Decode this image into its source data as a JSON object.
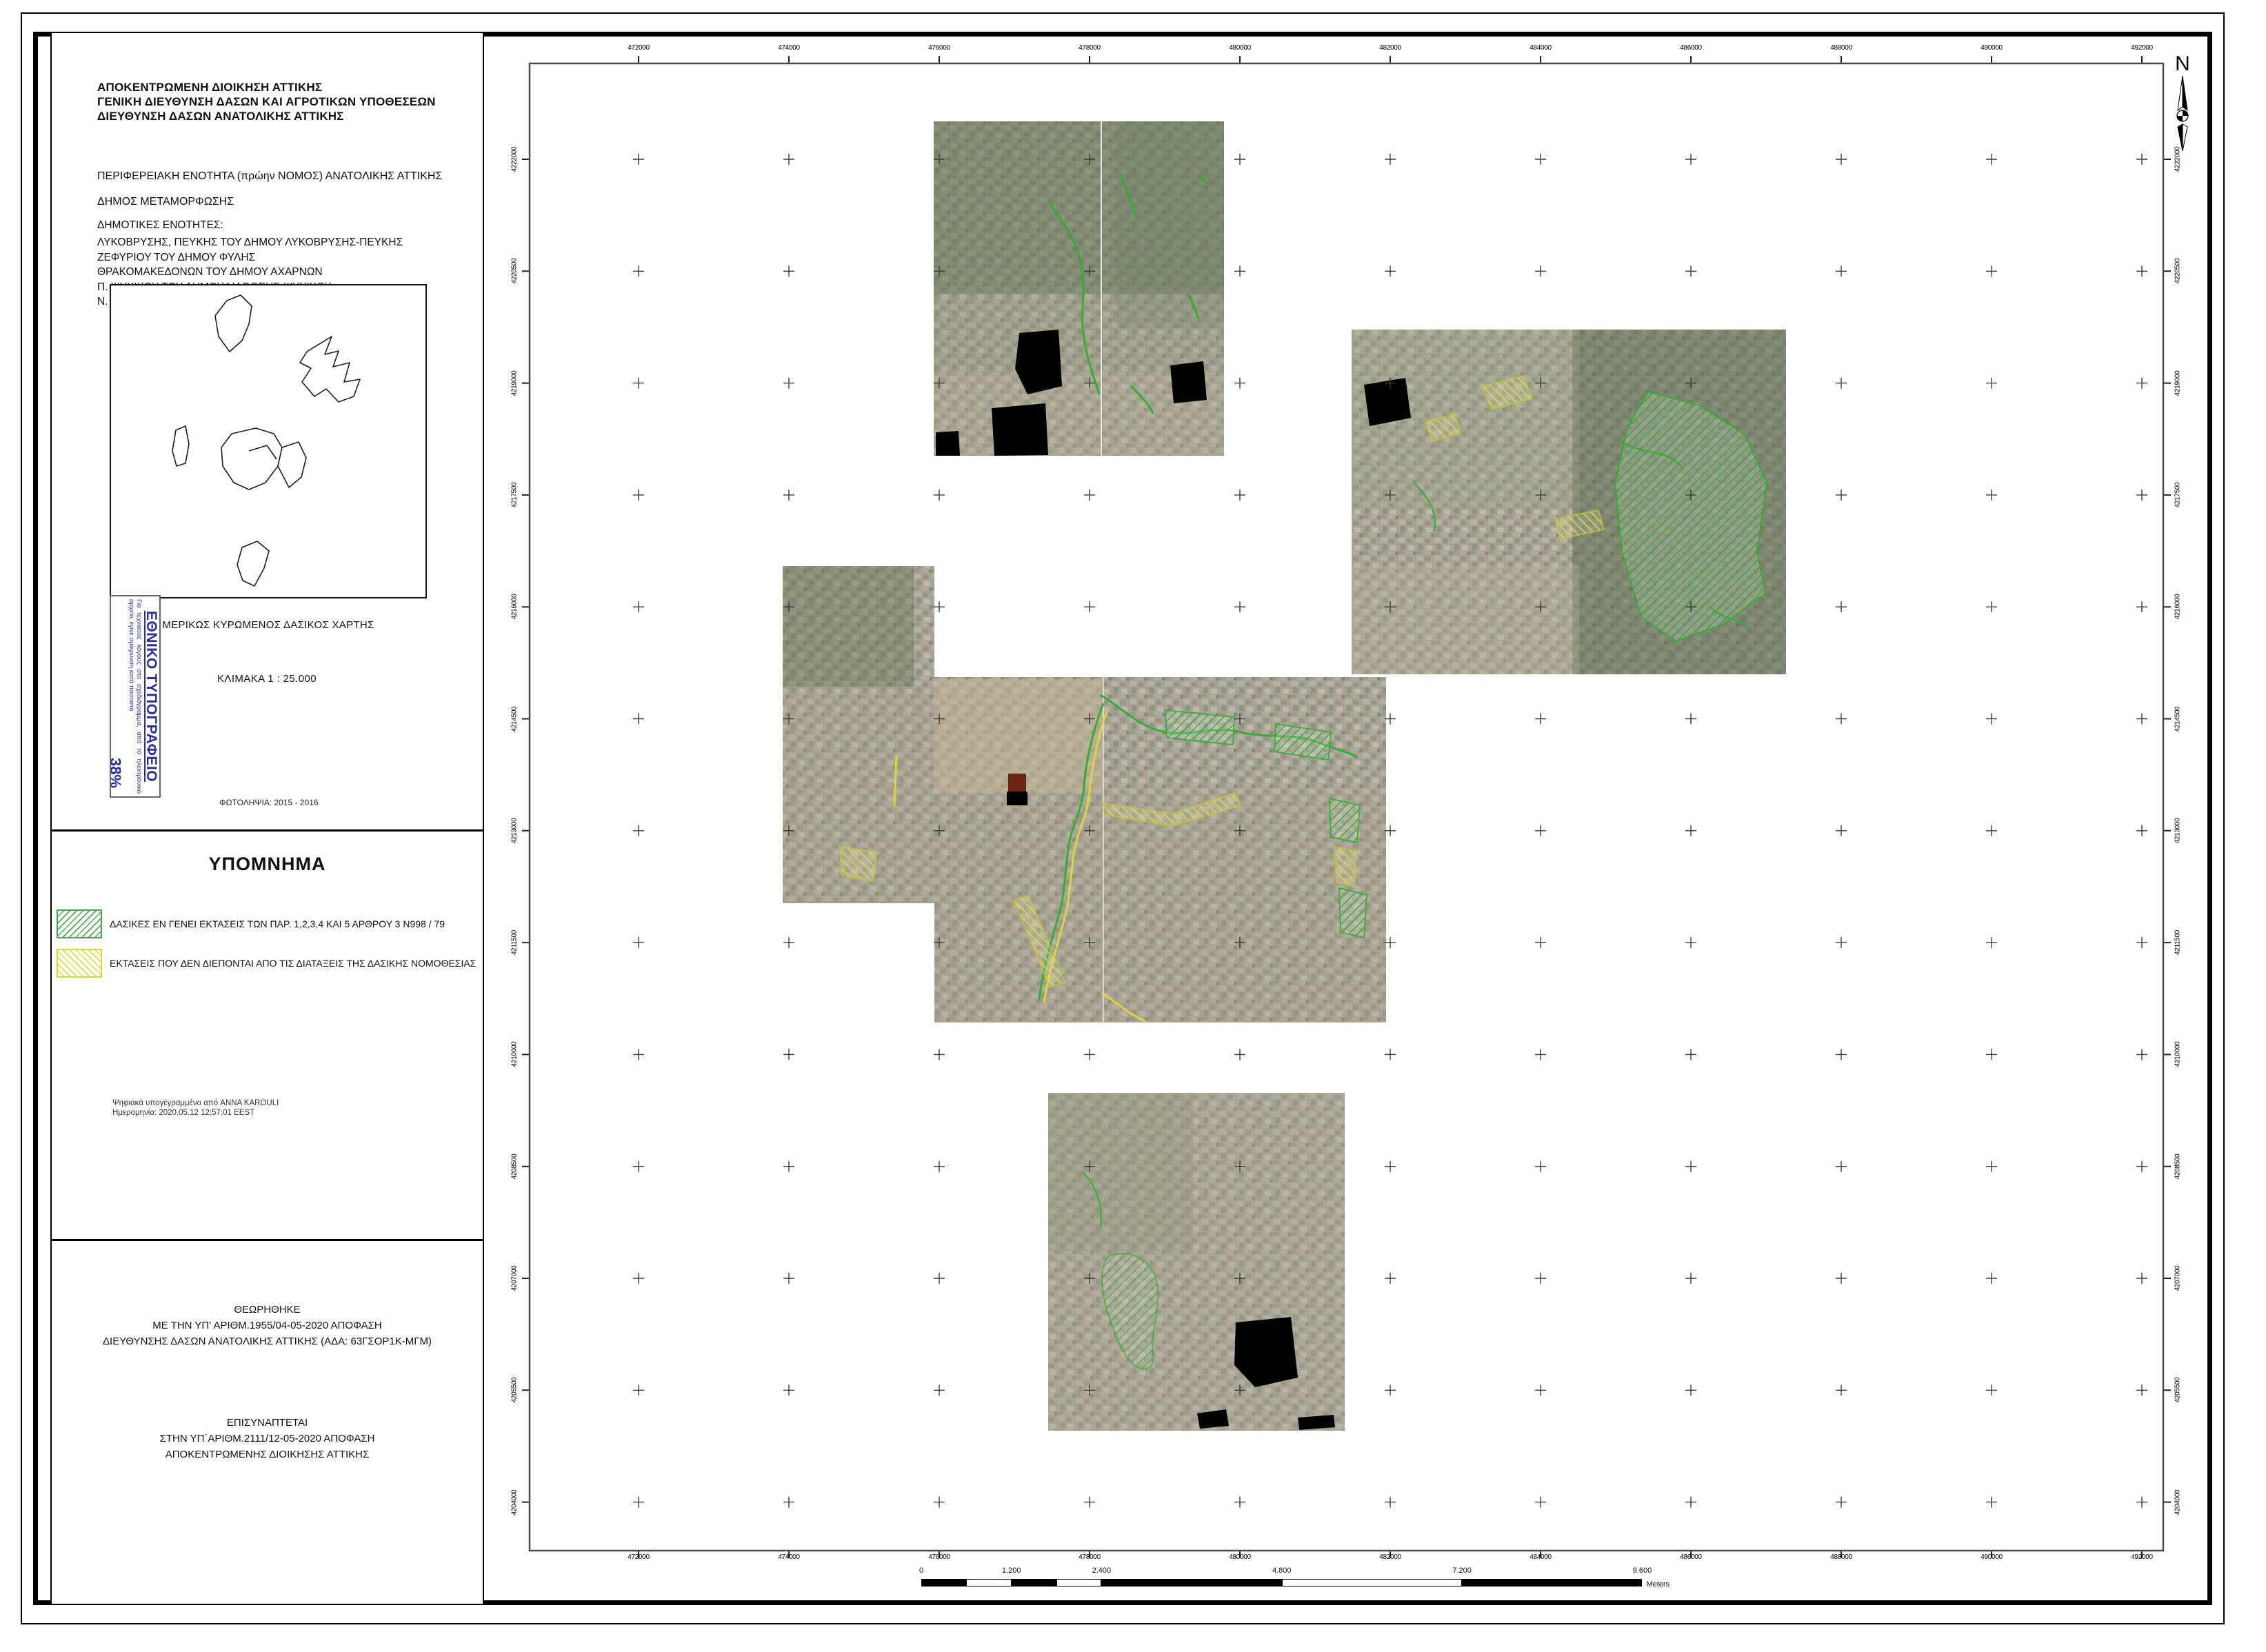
{
  "sidebar": {
    "agency_lines": [
      "ΑΠΟΚΕΝΤΡΩΜΕΝΗ ΔΙΟΙΚΗΣΗ ΑΤΤΙΚΗΣ",
      "ΓΕΝΙΚΗ ΔΙΕΥΘΥΝΣΗ ΔΑΣΩΝ ΚΑΙ ΑΓΡΟΤΙΚΩΝ ΥΠΟΘΕΣΕΩΝ",
      "ΔΙΕΥΘΥΝΣΗ ΔΑΣΩΝ ΑΝΑΤΟΛΙΚΗΣ ΑΤΤΙΚΗΣ"
    ],
    "region": "ΠΕΡΙΦΕΡΕΙΑΚΗ ΕΝΟΤΗΤΑ (πρώην ΝΟΜΟΣ) ΑΝΑΤΟΛΙΚΗΣ ΑΤΤΙΚΗΣ",
    "municipality": "ΔΗΜΟΣ ΜΕΤΑΜΟΡΦΩΣΗΣ",
    "municipal_units_label": "ΔΗΜΟΤΙΚΕΣ ΕΝΟΤΗΤΕΣ:",
    "municipal_units": [
      "ΛΥΚΟΒΡΥΣΗΣ, ΠΕΥΚΗΣ ΤΟΥ ΔΗΜΟΥ ΛΥΚΟΒΡΥΣΗΣ-ΠΕΥΚΗΣ",
      "ΖΕΦΥΡΙΟΥ ΤΟΥ ΔΗΜΟΥ ΦΥΛΗΣ",
      "ΘΡΑΚΟΜΑΚΕΔΟΝΩΝ ΤΟΥ ΔΗΜΟΥ ΑΧΑΡΝΩΝ",
      "Π. ΨΥΧΙΚΟΥ ΤΟΥ ΔΗΜΟΥΦΙΛΟΘΕΗΣ-ΨΥΧΙΚΟΥ",
      "Ν. ΕΡΥΘΡΑΙΑΣ ΤΟΥ ΔΗΜΟΥ ΚΗΦΙΣΙΑΣ"
    ],
    "overview_caption": "ΜΕΡΙΚΩΣ ΚΥΡΩΜΕΝΟΣ ΔΑΣΙΚΟΣ ΧΑΡΤΗΣ",
    "scale_label": "ΚΛΙΜΑΚΑ   1 : 25.000",
    "photo_label": "ΦΩΤΟΛΗΨΙΑ:   2015 - 2016",
    "stamp": {
      "title": "ΕΘΝΙΚΟ ΤΥΠΟΓΡΑΦΕΙΟ",
      "body": "Για τεχνικούς λόγους στο σχεδιάγραμμα, από το ηλεκτρονικό αρχείο, έγινε σμίκρυνση κατά ποσοστό",
      "percent": "38%",
      "color": "#2b2f9e"
    },
    "legend": {
      "title": "ΥΠΟΜΝΗΜΑ",
      "items": [
        {
          "label": "ΔΑΣΙΚΕΣ ΕΝ ΓΕΝΕΙ ΕΚΤΑΣΕΙΣ ΤΩΝ ΠΑΡ. 1,2,3,4 ΚΑΙ 5 ΑΡΘΡΟΥ 3 Ν998 / 79",
          "hatch_color": "#54a854",
          "hatch_direction": "forward-slash"
        },
        {
          "label": "ΕΚΤΑΣΕΙΣ ΠΟΥ ΔΕΝ ΔΙΕΠΟΝΤΑΙ ΑΠΟ ΤΙΣ ΔΙΑΤΑΞΕΙΣ ΤΗΣ ΔΑΣΙΚΗΣ ΝΟΜΟΘΕΣΙΑΣ",
          "hatch_color": "#e0da45",
          "hatch_direction": "back-slash"
        }
      ]
    },
    "signature": {
      "line1": "Ψηφιακά υπογεγραμμένο από ANNA KAROULI",
      "line2": "Ημερομηνία: 2020.05.12 12:57:01 EEST"
    },
    "approved_block": {
      "lines": [
        "ΘΕΩΡΗΘΗΚΕ",
        "ΜΕ ΤΗΝ ΥΠ' ΑΡΙΘΜ.1955/04-05-2020 ΑΠΟΦΑΣΗ",
        "ΔΙΕΥΘΥΝΣΗΣ ΔΑΣΩΝ ΑΝΑΤΟΛΙΚΗΣ ΑΤΤΙΚΗΣ (ΑΔΑ: 63ΓΣΟΡ1Κ-ΜΓΜ)"
      ]
    },
    "attached_block": {
      "lines": [
        "ΕΠΙΣΥΝΑΠΤΕΤΑΙ",
        "ΣΤΗΝ ΥΠ΄ΑΡΙΘΜ.2111/12-05-2020 ΑΠΟΦΑΣΗ",
        "ΑΠΟΚΕΝΤΡΩΜΕΝΗΣ ΔΙΟΙΚΗΣΗΣ ΑΤΤΙΚΗΣ"
      ]
    }
  },
  "map": {
    "north_label": "N",
    "top_coords": [
      "472000",
      "474000",
      "476000",
      "478000",
      "480000",
      "482000",
      "484000",
      "486000",
      "488000",
      "490000",
      "492000"
    ],
    "bottom_coords": [
      "472000",
      "474000",
      "476000",
      "478000",
      "480000",
      "482000",
      "484000",
      "486000",
      "488000",
      "490000",
      "492000"
    ],
    "left_coords": [
      "4222000",
      "4220500",
      "4219000",
      "4217500",
      "4216000",
      "4214500",
      "4213000",
      "4211500",
      "4210000",
      "4208500",
      "4207000",
      "4205500",
      "4204000"
    ],
    "right_coords": [
      "4222000",
      "4220500",
      "4219000",
      "4217500",
      "4216000",
      "4214500",
      "4213000",
      "4211500",
      "4210000",
      "4208500",
      "4207000",
      "4205500",
      "4204000"
    ],
    "scalebar": {
      "ticks": [
        {
          "label": "0",
          "meters": 0
        },
        {
          "label": "1.200",
          "meters": 1200
        },
        {
          "label": "2.400",
          "meters": 2400
        },
        {
          "label": "4.800",
          "meters": 4800
        },
        {
          "label": "7.200",
          "meters": 7200
        },
        {
          "label": "9.600",
          "meters": 9600
        }
      ],
      "segment_bounds": [
        0,
        600,
        1200,
        1800,
        2400,
        4800,
        7200,
        9600
      ],
      "unit": "Meters"
    }
  },
  "colors": {
    "hatch_green": "#2fae2f",
    "hatch_yellow": "#ddd83a",
    "stamp_blue": "#2b2f9e",
    "frame_gray": "#4a4a4a",
    "masked_area_black": "#000000"
  }
}
